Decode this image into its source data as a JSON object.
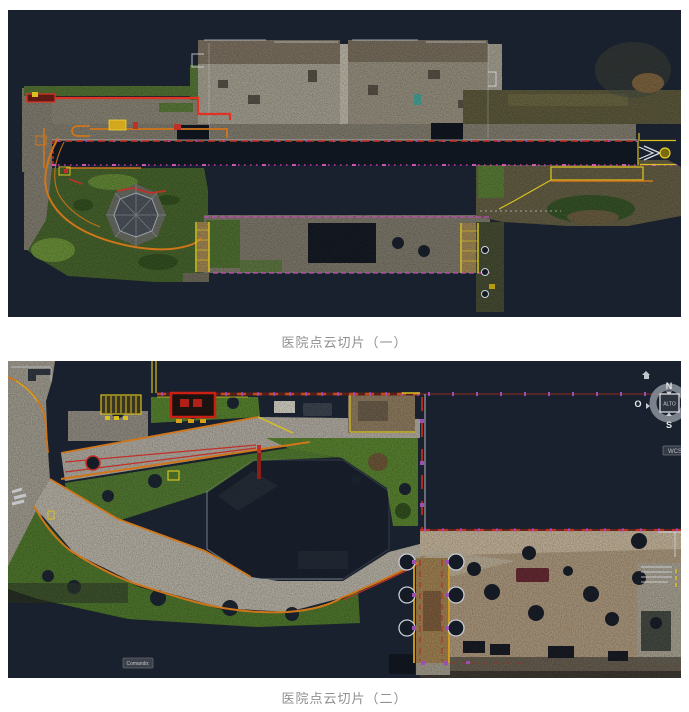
{
  "page": {
    "background_color": "#ffffff"
  },
  "figure1": {
    "caption": "医院点云切片（一）"
  },
  "figure2": {
    "caption": "医院点云切片（二）",
    "viewcube": {
      "north_label": "N",
      "south_label": "S",
      "west_label": "O",
      "top_face_label": "ALTO",
      "wcs_label": "WCS"
    },
    "command_line": {
      "text": "Comando:"
    }
  },
  "palette": {
    "canvas_background": "#1a212e",
    "cad_red": "#e03222",
    "cad_dark_red": "#b02820",
    "cad_orange": "#d0761a",
    "cad_yellow": "#d8c020",
    "cad_magenta": "#e44ac4",
    "cad_purple": "#9b4fb5",
    "pointcloud_gray": "#8d897c",
    "pointcloud_green": "#4a7028",
    "pointcloud_brown": "#93826b"
  }
}
